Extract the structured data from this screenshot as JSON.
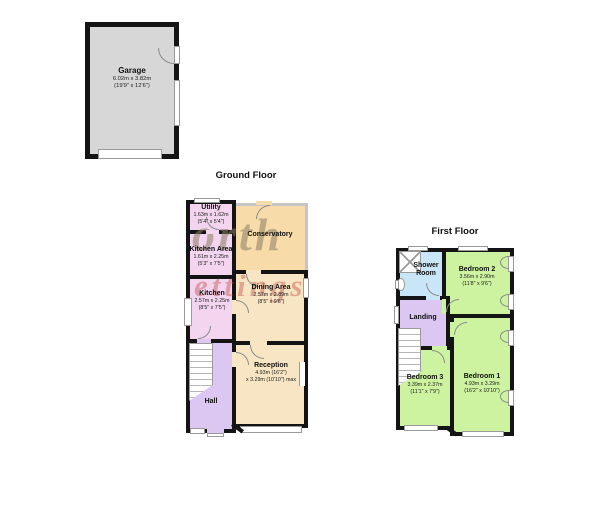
{
  "garage": {
    "name": "Garage",
    "dims_m": "6.02m x 3.82m",
    "dims_ft": "(19'9\" x 12'6\")"
  },
  "ground": {
    "title": "Ground Floor",
    "rooms": {
      "utility": {
        "name": "Utility",
        "dims_m": "1.63m x 1.62m",
        "dims_ft": "(5'4\" x 5'4\")"
      },
      "conservatory": {
        "name": "Conservatory"
      },
      "kitchen_area": {
        "name": "Kitchen Area",
        "dims_m": "1.61m x 2.25m",
        "dims_ft": "(5'3\" x 7'5\")"
      },
      "kitchen": {
        "name": "Kitchen",
        "dims_m": "2.57m x 2.25m",
        "dims_ft": "(8'5\" x 7'5\")"
      },
      "dining": {
        "name": "Dining Area",
        "dims_m": "2.57m x 2.89m",
        "dims_ft": "(8'5\" x 9'6\")"
      },
      "hall": {
        "name": "Hall"
      },
      "reception": {
        "name": "Reception",
        "dims_line1": "4.93m (16'2\")",
        "dims_line2": "x 3.29m (10'10\") max"
      }
    }
  },
  "first": {
    "title": "First Floor",
    "rooms": {
      "shower": {
        "name": "Shower Room"
      },
      "bedroom2": {
        "name": "Bedroom 2",
        "dims_m": "3.56m x 2.90m",
        "dims_ft": "(11'8\" x 9'6\")"
      },
      "landing": {
        "name": "Landing"
      },
      "bedroom3": {
        "name": "Bedroom 3",
        "dims_m": "3.39m x 2.37m",
        "dims_ft": "(11'1\" x 7'9\")"
      },
      "bedroom1": {
        "name": "Bedroom 1",
        "dims_m": "4.93m x 3.29m",
        "dims_ft": "(16'2\" x 10'10\")"
      }
    }
  },
  "watermark": {
    "line1": "orth",
    "line2": "ettings"
  },
  "colors": {
    "wall": "#141414",
    "garage_fill": "#d7d7d7",
    "pink": "#f3d5ef",
    "purple": "#dcc6f2",
    "tan": "#f8e5c3",
    "conservatory_fill": "#f7dcaa",
    "green": "#cdf3a0",
    "blue": "#c8e6f7"
  }
}
